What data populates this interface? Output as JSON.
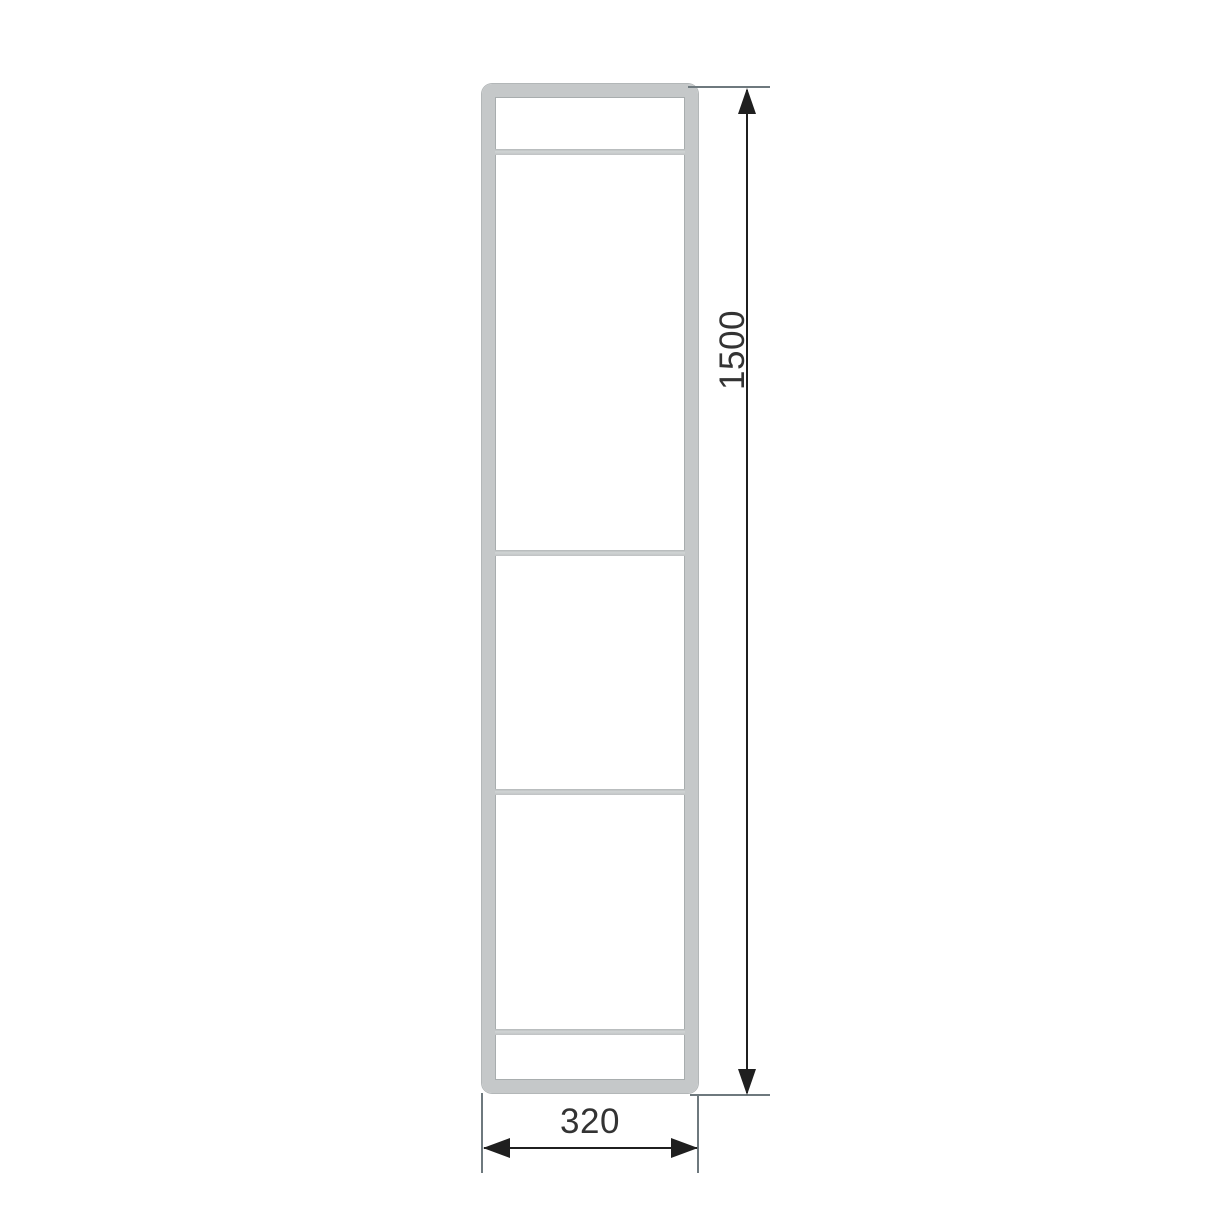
{
  "drawing": {
    "type": "technical-drawing",
    "object": "ladder-frame-front-elevation",
    "crossbar_count": 4
  },
  "dimensions": {
    "height": {
      "value": "1500",
      "orientation": "vertical"
    },
    "width": {
      "value": "320",
      "orientation": "horizontal"
    }
  },
  "colors": {
    "background": "#ffffff",
    "frame_fill": "#c5c8c9",
    "frame_edge": "#a8adae",
    "dimension_line": "#1f1f1f",
    "extension_line": "#6e797e",
    "label_text": "#333333"
  }
}
